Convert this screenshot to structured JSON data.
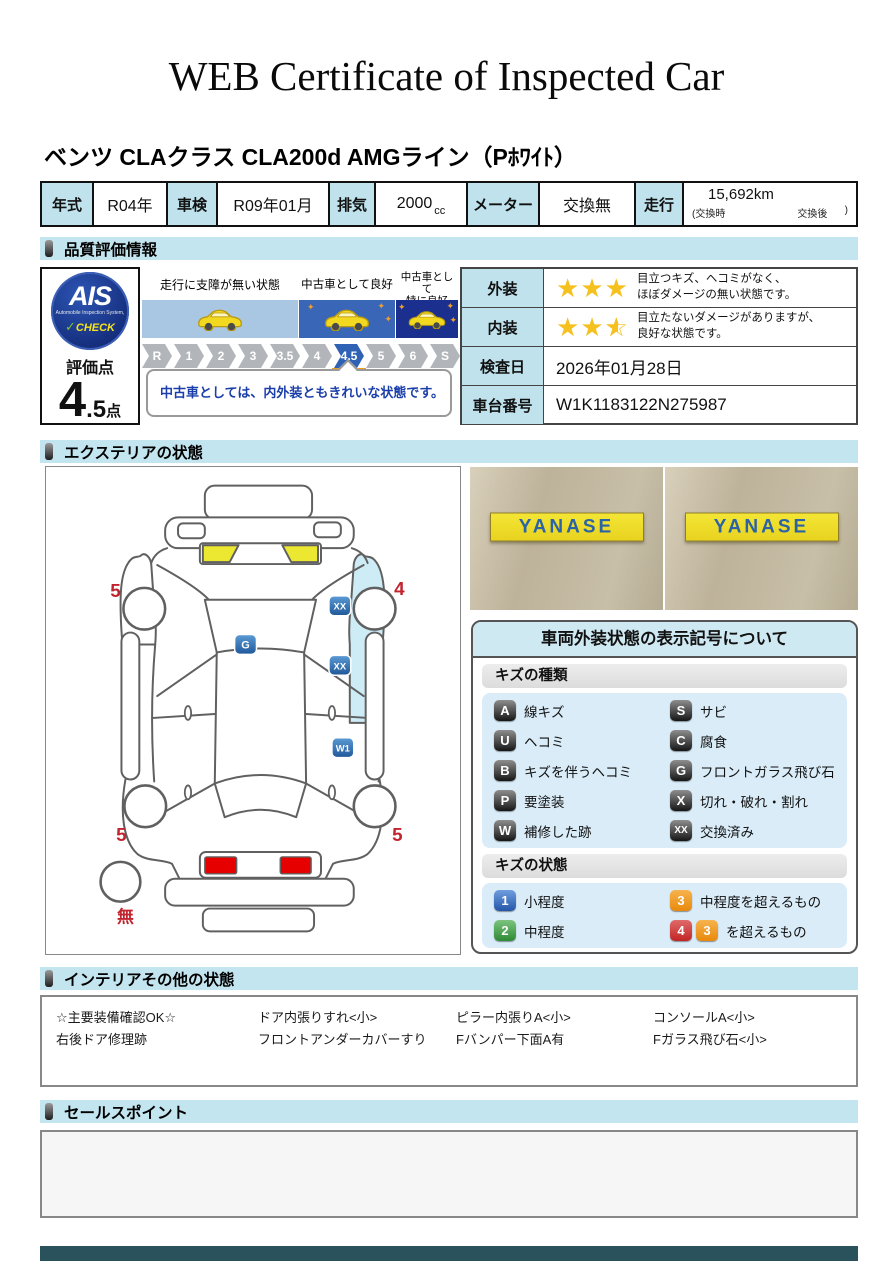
{
  "title": "WEB Certificate of Inspected Car",
  "vehicle_name": "ベンツ CLAクラス CLA200d AMGライン（Pﾎﾜｲﾄ）",
  "info": {
    "year_label": "年式",
    "year_value": "R04年",
    "shaken_label": "車検",
    "shaken_value": "R09年01月",
    "disp_label": "排気",
    "disp_value": "2000",
    "disp_unit": "cc",
    "meter_label": "メーター",
    "meter_value": "交換無",
    "mileage_label": "走行",
    "mileage_value": "15,692km",
    "note_open": "(交換時",
    "note_mid": "交換後",
    "note_close": ")"
  },
  "sections": {
    "quality": "品質評価情報",
    "exterior": "エクステリアの状態",
    "interior": "インテリアその他の状態",
    "sales": "セールスポイント"
  },
  "ais": {
    "logo_main": "AIS",
    "logo_sub": "Automobile Inspection System,",
    "logo_check": "CHECK",
    "score_label": "評価点",
    "score_big": "4",
    "score_small": ".5",
    "score_unit": "点"
  },
  "scale": {
    "bands": [
      {
        "label": "走行に支障が無い状態",
        "color": "#a9c6e2"
      },
      {
        "label": "中古車として良好",
        "color": "#3a66b8"
      },
      {
        "line1": "中古車として",
        "line2": "特に良好",
        "color": "#1a2f8e"
      }
    ],
    "ticks": [
      "R",
      "1",
      "2",
      "3",
      "3.5",
      "4",
      "4.5",
      "5",
      "6",
      "S"
    ],
    "active_tick": "4.5",
    "comment": "中古車としては、内外装ともきれいな状態です。"
  },
  "eval_table": {
    "exterior_label": "外装",
    "exterior_stars": 3,
    "exterior_line1": "目立つキズ、ヘコミがなく、",
    "exterior_line2": "ほぼダメージの無い状態です。",
    "interior_label": "内装",
    "interior_stars": 2.5,
    "interior_line1": "目立たないダメージがありますが、",
    "interior_line2": "良好な状態です。",
    "date_label": "検査日",
    "date_value": "2026年01月28日",
    "vin_label": "車台番号",
    "vin_value": "W1K1183122N275987"
  },
  "diagram": {
    "tires": {
      "front_left": "5",
      "front_right": "4",
      "rear_left": "5",
      "rear_right": "5",
      "spare": "無"
    },
    "badges": {
      "windshield": "G",
      "right_fender": "XX",
      "right_door": "XX",
      "right_rear_door": "W1"
    }
  },
  "photos": {
    "sign_text": "YANASE"
  },
  "legend": {
    "title": "車両外装状態の表示記号について",
    "kind_header": "キズの種類",
    "kinds": [
      {
        "code": "A",
        "label": "線キズ"
      },
      {
        "code": "S",
        "label": "サビ"
      },
      {
        "code": "U",
        "label": "ヘコミ"
      },
      {
        "code": "C",
        "label": "腐食"
      },
      {
        "code": "B",
        "label": "キズを伴うヘコミ"
      },
      {
        "code": "G",
        "label": "フロントガラス飛び石"
      },
      {
        "code": "P",
        "label": "要塗装"
      },
      {
        "code": "X",
        "label": "切れ・破れ・割れ"
      },
      {
        "code": "W",
        "label": "補修した跡"
      },
      {
        "code": "XX",
        "label": "交換済み"
      }
    ],
    "state_header": "キズの状態",
    "states": [
      {
        "code": "1",
        "label": "小程度",
        "color": "#2456a8"
      },
      {
        "code": "3",
        "label": "中程度を超えるもの",
        "color": "#e8890b"
      },
      {
        "code": "2",
        "label": "中程度",
        "color": "#2e8a33"
      },
      {
        "code": "4",
        "extra_code": "3",
        "label": "を超えるもの",
        "color": "#c22525"
      }
    ]
  },
  "interior_items": [
    "☆主要装備確認OK☆",
    "ドア内張りすれ<小>",
    "ピラー内張りA<小>",
    "コンソールA<小>",
    "右後ドア修理跡",
    "フロントアンダーカバーすり",
    "Fバンパー下面A有",
    "Fガラス飛び石<小>"
  ],
  "icons": {
    "star_full": "★",
    "star_outline": "☆",
    "sparkle": "✦",
    "check": "✓"
  },
  "colors": {
    "section_header_bg": "#c3e5ef",
    "table_label_bg": "#bfe2ec",
    "scale_active": "#2f62b5",
    "scale_marker_orange": "#f19a20",
    "comment_text": "#1b3faa",
    "diagram_badge_blue": "#2e6db8",
    "diagram_highlight": "#cdecf6",
    "diagram_yellow": "#ece832",
    "diagram_red_light": "#e60000",
    "diagram_number_red": "#c2242e",
    "star_gold": "#f5c11e",
    "photo_sign_bg": "#f0df2e",
    "photo_sign_text": "#2b63a5",
    "footer_bar": "#2a525c"
  }
}
